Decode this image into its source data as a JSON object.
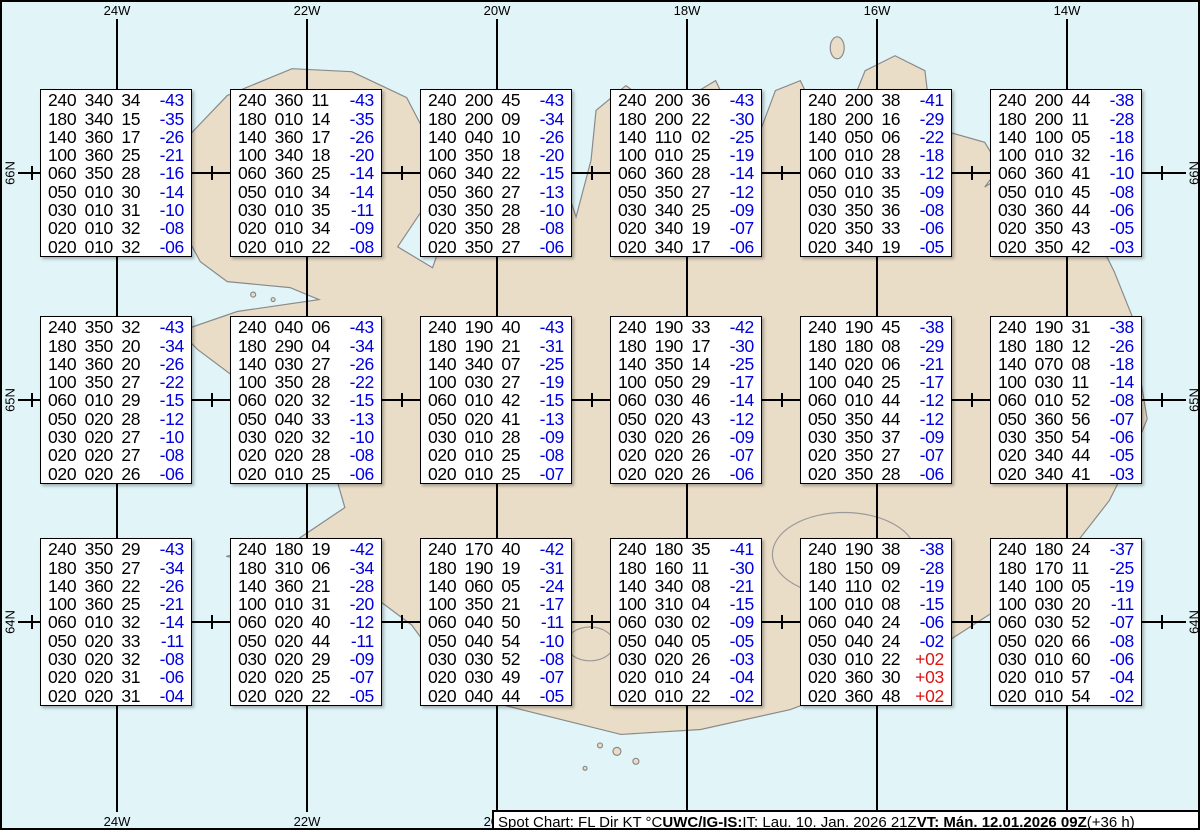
{
  "colors": {
    "ocean": "#E1F5F9",
    "land": "#EADDC8",
    "coast": "#8a8a8a",
    "grid": "#000000",
    "temp_neg": "#0000E0",
    "temp_pos": "#DC1414"
  },
  "chart_data": {
    "type": "table",
    "title": "Spot Chart: FL Dir KT °C",
    "columns": [
      "FL",
      "Dir",
      "KT",
      "°C"
    ],
    "meridians": [
      {
        "label": "24W",
        "x": 115
      },
      {
        "label": "22W",
        "x": 305
      },
      {
        "label": "20W",
        "x": 495
      },
      {
        "label": "18W",
        "x": 685
      },
      {
        "label": "16W",
        "x": 875
      },
      {
        "label": "14W",
        "x": 1065
      }
    ],
    "parallels": [
      {
        "label": "66N",
        "y": 171
      },
      {
        "label": "65N",
        "y": 398
      },
      {
        "label": "64N",
        "y": 620
      }
    ],
    "spot_xs": [
      210,
      400,
      590,
      780,
      970,
      1160
    ],
    "edge_tick_x": 30,
    "spots": [
      {
        "row": 0,
        "col": 0,
        "table": [
          [
            "240",
            "340",
            "34",
            "-43"
          ],
          [
            "180",
            "340",
            "15",
            "-35"
          ],
          [
            "140",
            "360",
            "17",
            "-26"
          ],
          [
            "100",
            "360",
            "25",
            "-21"
          ],
          [
            "060",
            "350",
            "28",
            "-16"
          ],
          [
            "050",
            "010",
            "30",
            "-14"
          ],
          [
            "030",
            "010",
            "31",
            "-10"
          ],
          [
            "020",
            "010",
            "32",
            "-08"
          ],
          [
            "020",
            "010",
            "32",
            "-06"
          ]
        ]
      },
      {
        "row": 0,
        "col": 1,
        "table": [
          [
            "240",
            "360",
            "11",
            "-43"
          ],
          [
            "180",
            "010",
            "14",
            "-35"
          ],
          [
            "140",
            "360",
            "17",
            "-26"
          ],
          [
            "100",
            "340",
            "18",
            "-20"
          ],
          [
            "060",
            "360",
            "25",
            "-14"
          ],
          [
            "050",
            "010",
            "34",
            "-14"
          ],
          [
            "030",
            "010",
            "35",
            "-11"
          ],
          [
            "020",
            "010",
            "34",
            "-09"
          ],
          [
            "020",
            "010",
            "22",
            "-08"
          ]
        ]
      },
      {
        "row": 0,
        "col": 2,
        "table": [
          [
            "240",
            "200",
            "45",
            "-43"
          ],
          [
            "180",
            "200",
            "09",
            "-34"
          ],
          [
            "140",
            "040",
            "10",
            "-26"
          ],
          [
            "100",
            "350",
            "18",
            "-20"
          ],
          [
            "060",
            "340",
            "22",
            "-15"
          ],
          [
            "050",
            "360",
            "27",
            "-13"
          ],
          [
            "030",
            "350",
            "28",
            "-10"
          ],
          [
            "020",
            "350",
            "28",
            "-08"
          ],
          [
            "020",
            "350",
            "27",
            "-06"
          ]
        ]
      },
      {
        "row": 0,
        "col": 3,
        "table": [
          [
            "240",
            "200",
            "36",
            "-43"
          ],
          [
            "180",
            "200",
            "22",
            "-30"
          ],
          [
            "140",
            "110",
            "02",
            "-25"
          ],
          [
            "100",
            "010",
            "25",
            "-19"
          ],
          [
            "060",
            "360",
            "28",
            "-14"
          ],
          [
            "050",
            "350",
            "27",
            "-12"
          ],
          [
            "030",
            "340",
            "25",
            "-09"
          ],
          [
            "020",
            "340",
            "19",
            "-07"
          ],
          [
            "020",
            "340",
            "17",
            "-06"
          ]
        ]
      },
      {
        "row": 0,
        "col": 4,
        "table": [
          [
            "240",
            "200",
            "38",
            "-41"
          ],
          [
            "180",
            "200",
            "16",
            "-29"
          ],
          [
            "140",
            "050",
            "06",
            "-22"
          ],
          [
            "100",
            "010",
            "28",
            "-18"
          ],
          [
            "060",
            "010",
            "33",
            "-12"
          ],
          [
            "050",
            "010",
            "35",
            "-09"
          ],
          [
            "030",
            "350",
            "36",
            "-08"
          ],
          [
            "020",
            "350",
            "33",
            "-06"
          ],
          [
            "020",
            "340",
            "19",
            "-05"
          ]
        ]
      },
      {
        "row": 0,
        "col": 5,
        "table": [
          [
            "240",
            "200",
            "44",
            "-38"
          ],
          [
            "180",
            "200",
            "11",
            "-28"
          ],
          [
            "140",
            "100",
            "05",
            "-18"
          ],
          [
            "100",
            "010",
            "32",
            "-16"
          ],
          [
            "060",
            "360",
            "41",
            "-10"
          ],
          [
            "050",
            "010",
            "45",
            "-08"
          ],
          [
            "030",
            "360",
            "44",
            "-06"
          ],
          [
            "020",
            "350",
            "43",
            "-05"
          ],
          [
            "020",
            "350",
            "42",
            "-03"
          ]
        ]
      },
      {
        "row": 1,
        "col": 0,
        "table": [
          [
            "240",
            "350",
            "32",
            "-43"
          ],
          [
            "180",
            "350",
            "20",
            "-34"
          ],
          [
            "140",
            "360",
            "20",
            "-26"
          ],
          [
            "100",
            "350",
            "27",
            "-22"
          ],
          [
            "060",
            "010",
            "29",
            "-15"
          ],
          [
            "050",
            "020",
            "28",
            "-12"
          ],
          [
            "030",
            "020",
            "27",
            "-10"
          ],
          [
            "020",
            "020",
            "27",
            "-08"
          ],
          [
            "020",
            "020",
            "26",
            "-06"
          ]
        ]
      },
      {
        "row": 1,
        "col": 1,
        "table": [
          [
            "240",
            "040",
            "06",
            "-43"
          ],
          [
            "180",
            "290",
            "04",
            "-34"
          ],
          [
            "140",
            "030",
            "27",
            "-26"
          ],
          [
            "100",
            "350",
            "28",
            "-22"
          ],
          [
            "060",
            "020",
            "32",
            "-15"
          ],
          [
            "050",
            "040",
            "33",
            "-13"
          ],
          [
            "030",
            "020",
            "32",
            "-10"
          ],
          [
            "020",
            "020",
            "28",
            "-08"
          ],
          [
            "020",
            "010",
            "25",
            "-06"
          ]
        ]
      },
      {
        "row": 1,
        "col": 2,
        "table": [
          [
            "240",
            "190",
            "40",
            "-43"
          ],
          [
            "180",
            "190",
            "21",
            "-31"
          ],
          [
            "140",
            "340",
            "07",
            "-25"
          ],
          [
            "100",
            "030",
            "27",
            "-19"
          ],
          [
            "060",
            "010",
            "42",
            "-15"
          ],
          [
            "050",
            "020",
            "41",
            "-13"
          ],
          [
            "030",
            "010",
            "28",
            "-09"
          ],
          [
            "020",
            "010",
            "25",
            "-08"
          ],
          [
            "020",
            "010",
            "25",
            "-07"
          ]
        ]
      },
      {
        "row": 1,
        "col": 3,
        "table": [
          [
            "240",
            "190",
            "33",
            "-42"
          ],
          [
            "180",
            "190",
            "17",
            "-30"
          ],
          [
            "140",
            "350",
            "14",
            "-25"
          ],
          [
            "100",
            "050",
            "29",
            "-17"
          ],
          [
            "060",
            "030",
            "46",
            "-14"
          ],
          [
            "050",
            "020",
            "43",
            "-12"
          ],
          [
            "030",
            "020",
            "26",
            "-09"
          ],
          [
            "020",
            "020",
            "26",
            "-07"
          ],
          [
            "020",
            "020",
            "26",
            "-06"
          ]
        ]
      },
      {
        "row": 1,
        "col": 4,
        "table": [
          [
            "240",
            "190",
            "45",
            "-38"
          ],
          [
            "180",
            "180",
            "08",
            "-29"
          ],
          [
            "140",
            "020",
            "06",
            "-21"
          ],
          [
            "100",
            "040",
            "25",
            "-17"
          ],
          [
            "060",
            "010",
            "44",
            "-12"
          ],
          [
            "050",
            "350",
            "44",
            "-12"
          ],
          [
            "030",
            "350",
            "37",
            "-09"
          ],
          [
            "020",
            "350",
            "27",
            "-07"
          ],
          [
            "020",
            "350",
            "28",
            "-06"
          ]
        ]
      },
      {
        "row": 1,
        "col": 5,
        "table": [
          [
            "240",
            "190",
            "31",
            "-38"
          ],
          [
            "180",
            "180",
            "12",
            "-26"
          ],
          [
            "140",
            "070",
            "08",
            "-18"
          ],
          [
            "100",
            "030",
            "11",
            "-14"
          ],
          [
            "060",
            "010",
            "52",
            "-08"
          ],
          [
            "050",
            "360",
            "56",
            "-07"
          ],
          [
            "030",
            "350",
            "54",
            "-06"
          ],
          [
            "020",
            "340",
            "44",
            "-05"
          ],
          [
            "020",
            "340",
            "41",
            "-03"
          ]
        ]
      },
      {
        "row": 2,
        "col": 0,
        "table": [
          [
            "240",
            "350",
            "29",
            "-43"
          ],
          [
            "180",
            "350",
            "27",
            "-34"
          ],
          [
            "140",
            "360",
            "22",
            "-26"
          ],
          [
            "100",
            "360",
            "25",
            "-21"
          ],
          [
            "060",
            "010",
            "32",
            "-14"
          ],
          [
            "050",
            "020",
            "33",
            "-11"
          ],
          [
            "030",
            "020",
            "32",
            "-08"
          ],
          [
            "020",
            "020",
            "31",
            "-06"
          ],
          [
            "020",
            "020",
            "31",
            "-04"
          ]
        ]
      },
      {
        "row": 2,
        "col": 1,
        "table": [
          [
            "240",
            "180",
            "19",
            "-42"
          ],
          [
            "180",
            "310",
            "06",
            "-34"
          ],
          [
            "140",
            "360",
            "21",
            "-28"
          ],
          [
            "100",
            "010",
            "31",
            "-20"
          ],
          [
            "060",
            "020",
            "40",
            "-12"
          ],
          [
            "050",
            "020",
            "44",
            "-11"
          ],
          [
            "030",
            "020",
            "29",
            "-09"
          ],
          [
            "020",
            "020",
            "25",
            "-07"
          ],
          [
            "020",
            "020",
            "22",
            "-05"
          ]
        ]
      },
      {
        "row": 2,
        "col": 2,
        "table": [
          [
            "240",
            "170",
            "40",
            "-42"
          ],
          [
            "180",
            "190",
            "19",
            "-31"
          ],
          [
            "140",
            "060",
            "05",
            "-24"
          ],
          [
            "100",
            "350",
            "21",
            "-17"
          ],
          [
            "060",
            "040",
            "50",
            "-11"
          ],
          [
            "050",
            "040",
            "54",
            "-10"
          ],
          [
            "030",
            "030",
            "52",
            "-08"
          ],
          [
            "020",
            "030",
            "49",
            "-07"
          ],
          [
            "020",
            "040",
            "44",
            "-05"
          ]
        ]
      },
      {
        "row": 2,
        "col": 3,
        "table": [
          [
            "240",
            "180",
            "35",
            "-41"
          ],
          [
            "180",
            "160",
            "11",
            "-30"
          ],
          [
            "140",
            "340",
            "08",
            "-21"
          ],
          [
            "100",
            "310",
            "04",
            "-15"
          ],
          [
            "060",
            "030",
            "02",
            "-09"
          ],
          [
            "050",
            "040",
            "05",
            "-05"
          ],
          [
            "030",
            "020",
            "26",
            "-03"
          ],
          [
            "020",
            "010",
            "24",
            "-04"
          ],
          [
            "020",
            "010",
            "22",
            "-02"
          ]
        ]
      },
      {
        "row": 2,
        "col": 4,
        "table": [
          [
            "240",
            "190",
            "38",
            "-38"
          ],
          [
            "180",
            "150",
            "09",
            "-28"
          ],
          [
            "140",
            "110",
            "02",
            "-19"
          ],
          [
            "100",
            "010",
            "08",
            "-15"
          ],
          [
            "060",
            "040",
            "24",
            "-06"
          ],
          [
            "050",
            "040",
            "24",
            "-02"
          ],
          [
            "030",
            "010",
            "22",
            "+02"
          ],
          [
            "020",
            "360",
            "30",
            "+03"
          ],
          [
            "020",
            "360",
            "48",
            "+02"
          ]
        ]
      },
      {
        "row": 2,
        "col": 5,
        "table": [
          [
            "240",
            "180",
            "24",
            "-37"
          ],
          [
            "180",
            "170",
            "11",
            "-25"
          ],
          [
            "140",
            "100",
            "05",
            "-19"
          ],
          [
            "100",
            "030",
            "20",
            "-11"
          ],
          [
            "060",
            "030",
            "52",
            "-07"
          ],
          [
            "050",
            "020",
            "66",
            "-08"
          ],
          [
            "030",
            "010",
            "60",
            "-06"
          ],
          [
            "020",
            "010",
            "57",
            "-04"
          ],
          [
            "020",
            "010",
            "54",
            "-02"
          ]
        ]
      }
    ]
  },
  "footer": {
    "segments": [
      {
        "text": "Spot Chart: FL Dir KT °C ",
        "bold": false
      },
      {
        "text": "UWC/IG-IS:",
        "bold": true
      },
      {
        "text": " IT: Lau. 10. Jan. 2026 21Z ",
        "bold": false
      },
      {
        "text": "VT: Mán. 12.01.2026 09Z",
        "bold": true
      },
      {
        "text": " (+36 h)",
        "bold": false
      }
    ]
  }
}
